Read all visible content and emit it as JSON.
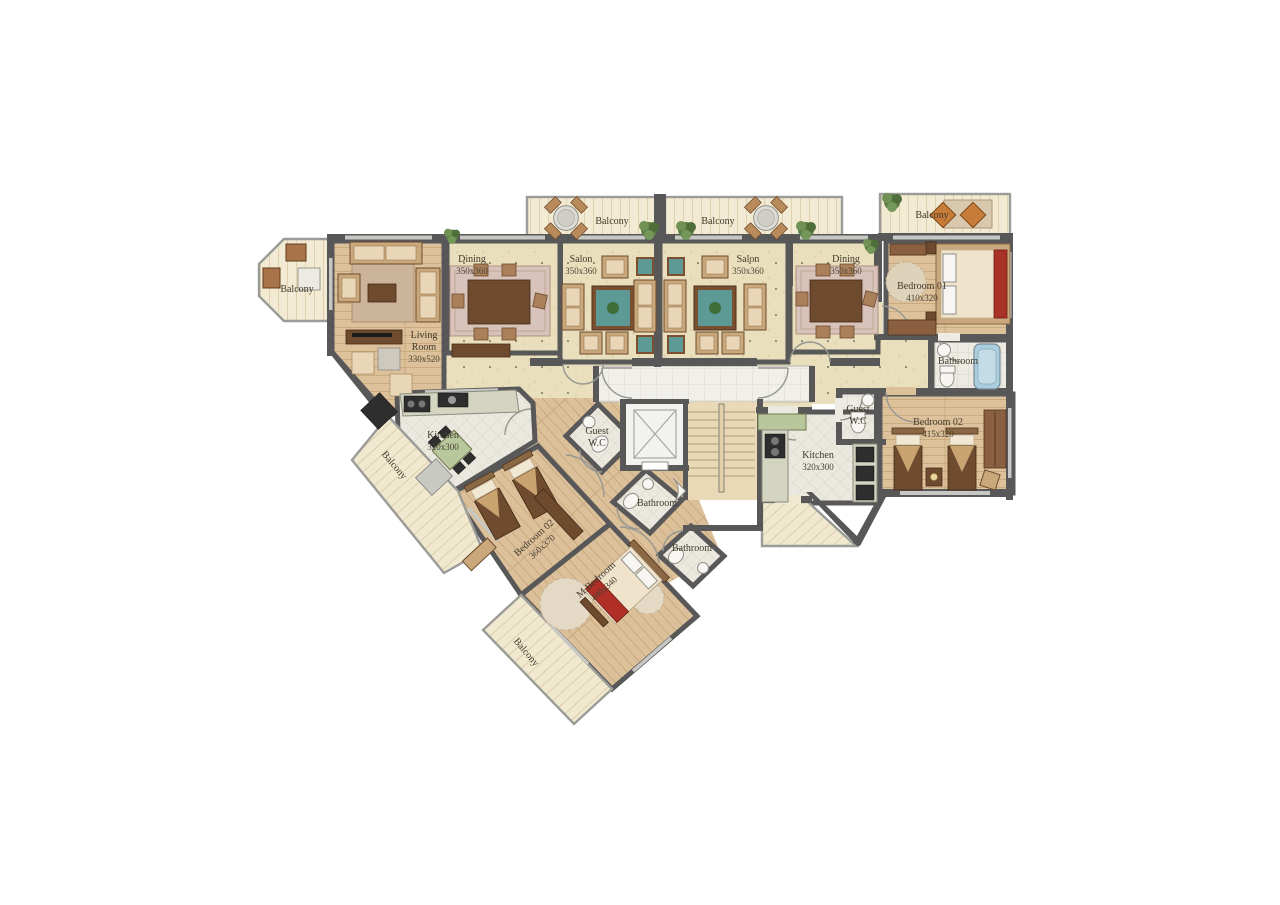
{
  "plan_type": "apartment-floor-plan",
  "rooms": {
    "balcony_bay": {
      "name": "Balcony"
    },
    "living": {
      "name": "Living",
      "name2": "Room",
      "dims": "330x520"
    },
    "dining_left": {
      "name": "Dining",
      "dims": "350x360"
    },
    "salon_left": {
      "name": "Salon",
      "dims": "350x360"
    },
    "balcony_top_left": {
      "name": "Balcony"
    },
    "balcony_top_right": {
      "name": "Balcony"
    },
    "salon_right": {
      "name": "Salon",
      "dims": "350x360"
    },
    "dining_right": {
      "name": "Dining",
      "dims": "350x360"
    },
    "balcony_right": {
      "name": "Balcony"
    },
    "bedroom01": {
      "name": "Bedroom 01",
      "dims": "410x320"
    },
    "bathroom_right": {
      "name": "Bathroom"
    },
    "bedroom02_right": {
      "name": "Bedroom 02",
      "dims": "415x320"
    },
    "guest_wc_right": {
      "name": "Guest",
      "name2": "W.C"
    },
    "kitchen_right": {
      "name": "Kitchen",
      "dims": "320x300"
    },
    "kitchen_left": {
      "name": "Kitchen",
      "dims": "320x300"
    },
    "guest_wc_left": {
      "name": "Guest",
      "name2": "W.C"
    },
    "bathroom_left1": {
      "name": "Bathroom"
    },
    "bathroom_left2": {
      "name": "Bathroom"
    },
    "bedroom02_left": {
      "name": "Bedroom 02",
      "dims": "360x370"
    },
    "mbedroom": {
      "name": "M.Bedroom",
      "dims": "490x340"
    },
    "balcony_wing": {
      "name": "Balcony"
    },
    "balcony_bottom": {
      "name": "Balcony"
    }
  },
  "colors": {
    "wall": "#585858",
    "floor_beige": "#e9dfbd",
    "floor_wood": "#ddc19b",
    "floor_tile": "#edebe3",
    "balcony_floor": "#f2ead2",
    "accent_red": "#a83226",
    "accent_teal": "#5d9a96",
    "plant_green": "#5e7d46",
    "tub_blue": "#a9cede"
  }
}
